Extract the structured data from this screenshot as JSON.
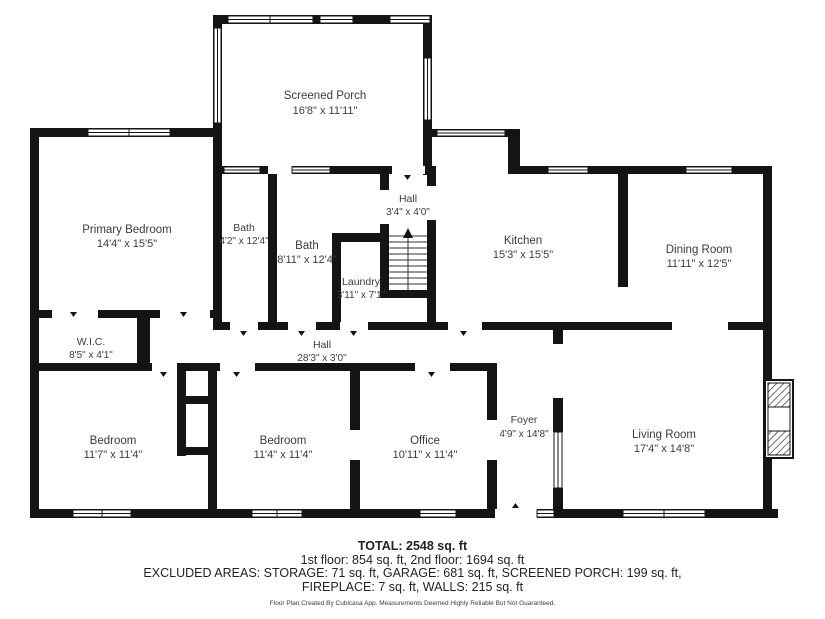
{
  "plan": {
    "rooms": [
      {
        "name": "Screened Porch",
        "dims": "16'8\" x 11'11\""
      },
      {
        "name": "Primary Bedroom",
        "dims": "14'4\" x 15'5\""
      },
      {
        "name": "Bath",
        "dims": "4'2\" x 12'4\""
      },
      {
        "name": "Bath",
        "dims": "8'11\" x 12'4\""
      },
      {
        "name": "Hall",
        "dims": "3'4\" x 4'0\""
      },
      {
        "name": "Laundry",
        "dims": "3'11\" x 7'1\""
      },
      {
        "name": "Kitchen",
        "dims": "15'3\" x 15'5\""
      },
      {
        "name": "Dining Room",
        "dims": "11'11\" x 12'5\""
      },
      {
        "name": "W.I.C.",
        "dims": "8'5\" x 4'1\""
      },
      {
        "name": "Hall",
        "dims": "28'3\" x 3'0\""
      },
      {
        "name": "Bedroom",
        "dims": "11'7\" x 11'4\""
      },
      {
        "name": "Bedroom",
        "dims": "11'4\" x 11'4\""
      },
      {
        "name": "Office",
        "dims": "10'11\" x 11'4\""
      },
      {
        "name": "Foyer",
        "dims": "4'9\" x 14'8\""
      },
      {
        "name": "Living Room",
        "dims": "17'4\" x 14'8\""
      }
    ]
  },
  "footer": {
    "total": "TOTAL: 2548 sq. ft",
    "floors": "1st floor: 854 sq. ft, 2nd floor: 1694 sq. ft",
    "excluded1": "EXCLUDED AREAS: STORAGE: 71 sq. ft, GARAGE: 681 sq. ft, SCREENED PORCH: 199 sq. ft,",
    "excluded2": "FIREPLACE: 7 sq. ft, WALLS: 215 sq. ft",
    "credit": "Floor Plan Created By Cubicasa App. Measurements Deemed Highly Reliable But Not Guaranteed."
  },
  "colors": {
    "wall": "#141414",
    "background": "#ffffff",
    "text": "#3b3b3b"
  }
}
